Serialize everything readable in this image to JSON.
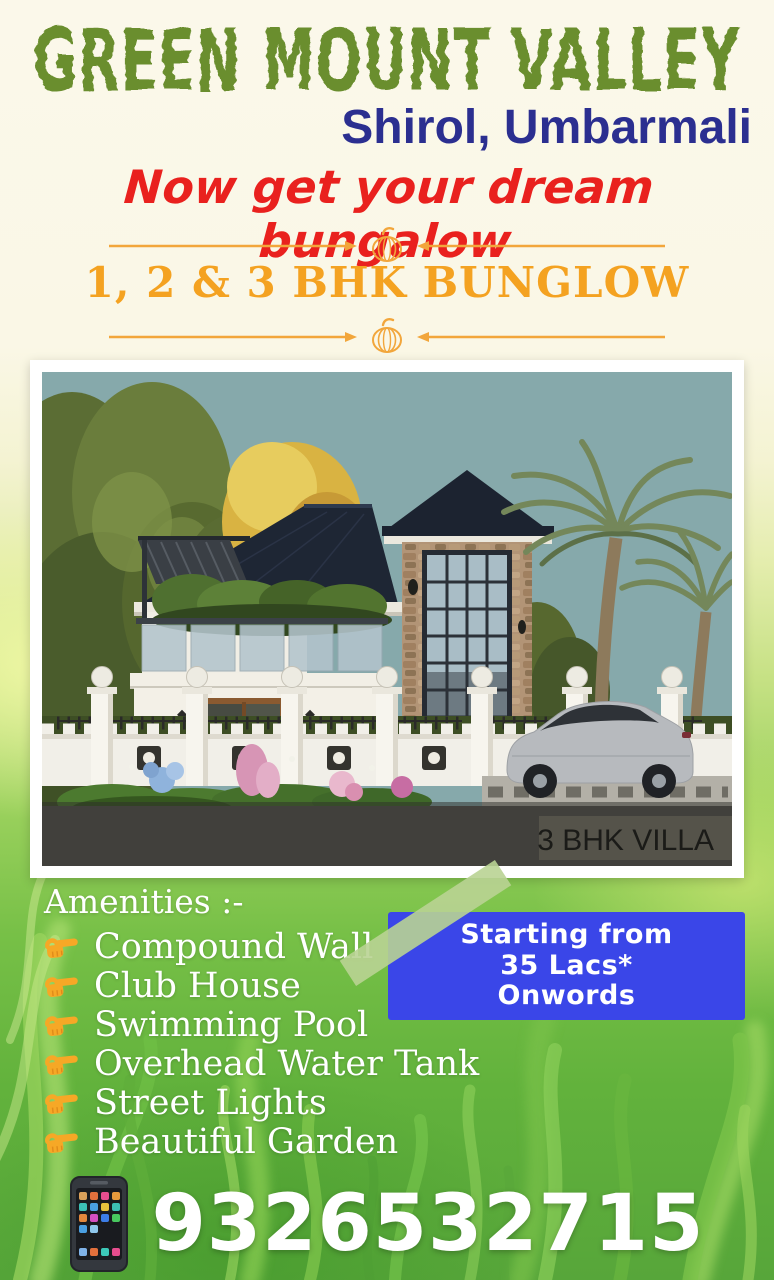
{
  "poster": {
    "title": "GREEN MOUNT VALLEY",
    "location": "Shirol, Umbarmali",
    "tagline": "Now get your dream bungalow",
    "offer_text": "1, 2 & 3 BHK BUNGLOW"
  },
  "villa_image": {
    "caption": "3 BHK VILLA"
  },
  "amenities": {
    "heading": "Amenities :-",
    "items": [
      "Compound Wall",
      "Club House",
      "Swimming Pool",
      "Overhead Water Tank",
      "Street Lights",
      "Beautiful Garden"
    ]
  },
  "pricing_badge": {
    "lines": [
      "Starting from",
      "35 Lacs*",
      "Onwords"
    ]
  },
  "contact": {
    "phone_number": "9326532715"
  },
  "icons": {
    "pumpkin_ornament": "🎃",
    "pointing_finger": "👉",
    "smartphone": "📱"
  },
  "colors": {
    "title_green": "#6b8e2e",
    "location_blue": "#2b2f90",
    "tagline_red": "#e9211e",
    "accent_orange": "#f2a63b",
    "offer_orange": "#f4a221",
    "badge_blue": "#3a46e8",
    "tape_green": "#b9d393",
    "text_white": "#ffffff"
  }
}
